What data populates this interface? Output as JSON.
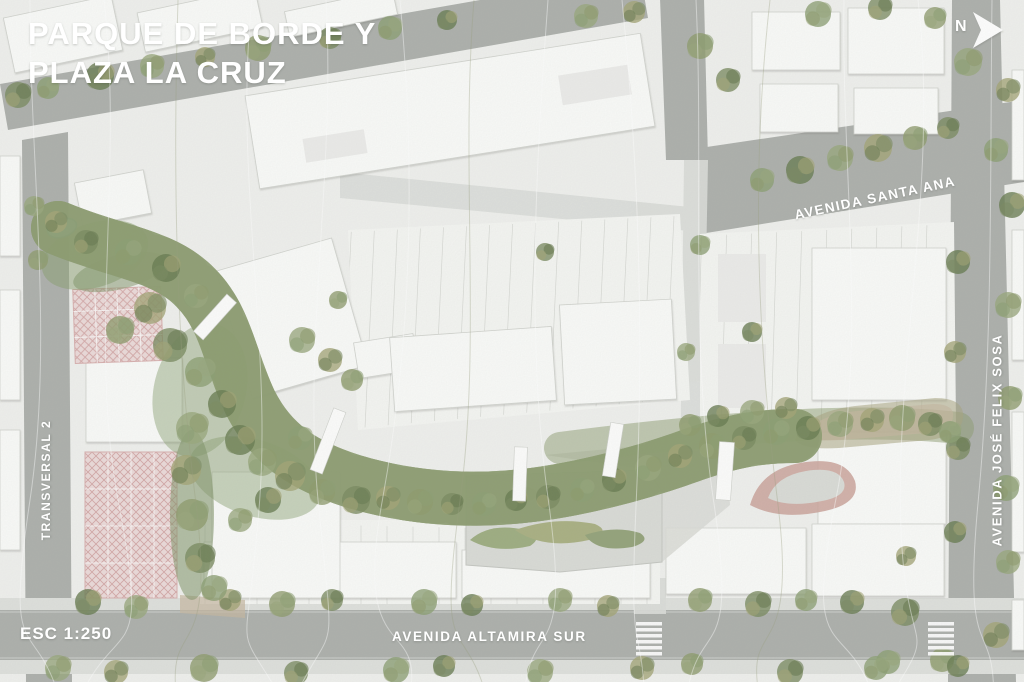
{
  "title": {
    "line1": "PARQUE DE BORDE Y",
    "line2": "PLAZA LA CRUZ"
  },
  "scale_label": "ESC 1:250",
  "north": {
    "letter": "N"
  },
  "streets": {
    "santa_ana": "AVENIDA SANTA ANA",
    "jose_felix_sosa": "AVENIDA JOSÉ FELIX SOSA",
    "transversal": "TRANSVERSAL 2",
    "altamira": "AVENIDA ALTAMIRA SUR"
  },
  "palette": {
    "background": "#e9ebe7",
    "ground": "#f0f1ee",
    "block_ground": "#f5f6f3",
    "building": "#fafbf9",
    "building_stroke": "#d2d4cf",
    "road": "#aeb1ad",
    "road_light": "#dcdeda",
    "sidewalk": "#dfe1dd",
    "water": "#a5d5de",
    "water_dark": "#79aeb8",
    "water_light": "#cfe9ee",
    "vegetation_band": "#8d9d72",
    "greens": [
      "#7b8c62",
      "#8da075",
      "#697c52",
      "#9aa87e",
      "#a4a577",
      "#8f9c6e"
    ],
    "court_base": "#ecdbda",
    "court_hatch": "#d0a0a0",
    "court_line": "#ffffff",
    "path_tan": "#c6b8a1",
    "path_red": "#cba49c",
    "plaza": "#dadcd7",
    "label_text": "#ffffff"
  }
}
